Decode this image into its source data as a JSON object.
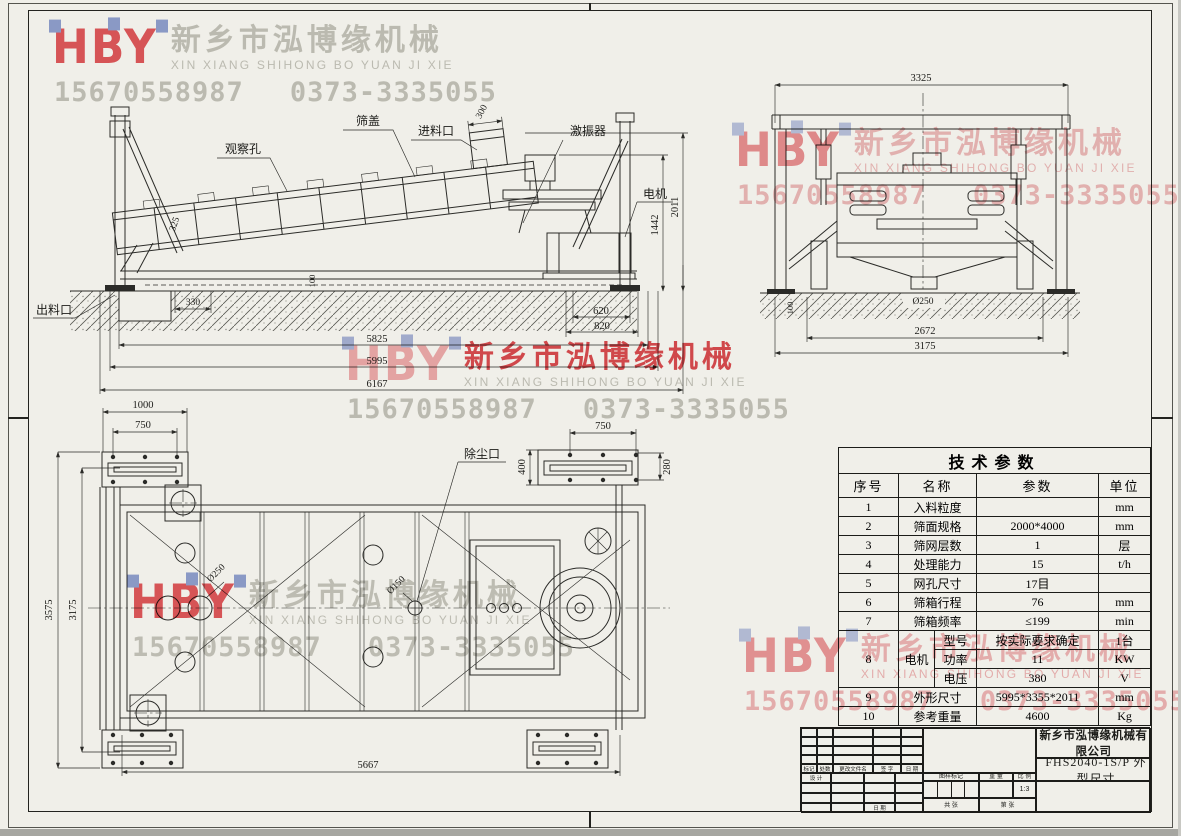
{
  "watermark": {
    "logo_text": "HBY",
    "company_cn": "新乡市泓博缘机械",
    "company_pinyin": "XIN XIANG SHIHONG BO YUAN JI XIE",
    "phone_mobile": "15670558987",
    "phone_tel": "0373-3335055",
    "colors": {
      "red": "#e4595e",
      "pink": "#f0bcbf",
      "gray": "#c7c7c1",
      "blue": "#93a3d8"
    }
  },
  "side_view": {
    "labels": {
      "observation_hole": "观察孔",
      "screen_cover": "筛盖",
      "feed_inlet": "进料口",
      "exciter": "激振器",
      "motor": "电机",
      "discharge_outlet": "出料口"
    },
    "dims": {
      "feed_opening": "300",
      "body_side": "325",
      "base_channel": "100",
      "discharge_pit": "330",
      "pit_inner": "620",
      "pit_outer": "820",
      "support_span": "5825",
      "base_length": "5995",
      "overall_length": "6167",
      "motor_platform_height": "1442",
      "overall_height": "2011"
    }
  },
  "end_view": {
    "dims": {
      "overall_width": "3325",
      "base_offset": "100",
      "outlet_diameter": "Ø250",
      "support_span": "2672",
      "base_width": "3175"
    }
  },
  "plan_view": {
    "labels": {
      "dust_port": "除尘口"
    },
    "dims": {
      "plate_length": "1000",
      "bolt_span_left": "750",
      "bolt_span_right": "750",
      "plate_width": "400",
      "bolt_width": "280",
      "overall_width": "3575",
      "body_width": "3175",
      "hole_diameter": "Ø250",
      "dust_port_diameter": "Ø150",
      "anchor_span": "5667"
    }
  },
  "spec_table": {
    "title": "技术参数",
    "headers": {
      "no": "序号",
      "name": "名称",
      "value": "参数",
      "unit": "单位"
    },
    "rows": [
      {
        "no": "1",
        "name": "入料粒度",
        "value": "",
        "unit": "mm"
      },
      {
        "no": "2",
        "name": "筛面规格",
        "value": "2000*4000",
        "unit": "mm"
      },
      {
        "no": "3",
        "name": "筛网层数",
        "value": "1",
        "unit": "层"
      },
      {
        "no": "4",
        "name": "处理能力",
        "value": "15",
        "unit": "t/h"
      },
      {
        "no": "5",
        "name": "网孔尺寸",
        "value": "17目",
        "unit": ""
      },
      {
        "no": "6",
        "name": "筛箱行程",
        "value": "76",
        "unit": "mm"
      },
      {
        "no": "7",
        "name": "筛箱频率",
        "value": "≤199",
        "unit": "min"
      }
    ],
    "motor": {
      "no": "8",
      "name": "电机",
      "subrows": [
        {
          "label": "型号",
          "value": "按实际要求确定",
          "unit": "1台"
        },
        {
          "label": "功率",
          "value": "11",
          "unit": "KW"
        },
        {
          "label": "电压",
          "value": "380",
          "unit": "V"
        }
      ]
    },
    "rows_tail": [
      {
        "no": "9",
        "name": "外形尺寸",
        "value": "5995*3355*2011",
        "unit": "mm"
      },
      {
        "no": "10",
        "name": "参考重量",
        "value": "4600",
        "unit": "Kg"
      }
    ]
  },
  "title_block": {
    "company": "新乡市泓博缘机械有限公司",
    "drawing_title": "FHS2040-1S/P  外型尺寸",
    "labels": {
      "mark": "标记",
      "count": "处数",
      "change_doc": "更改文件名",
      "signature": "签 字",
      "date": "日 期",
      "design": "设 计",
      "date2": "日 期",
      "drawing_mark": "图样标记",
      "weight": "重 量",
      "scale": "比 例",
      "scale_value": "1:3",
      "sheets_total": "共  张",
      "sheet_no": "第  张"
    }
  }
}
